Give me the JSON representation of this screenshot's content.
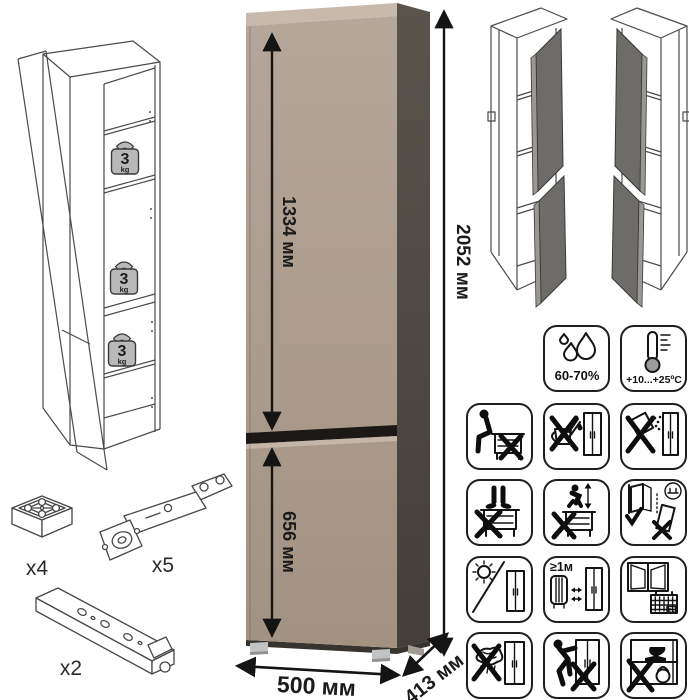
{
  "page": {
    "background": "#ffffff"
  },
  "colors": {
    "cabinet_front_top": "#b4a699",
    "cabinet_front_bottom": "#a29282",
    "cabinet_top_strip": "#c7b9ac",
    "cabinet_side": "#4d4944",
    "door_gap": "#1b1815",
    "open_door": "#6e6c69",
    "open_door_edge": "#9b9893",
    "line_art": "#4b4b4b",
    "ink": "#161616",
    "weight_badge": "#b9b9b9"
  },
  "dimensions": {
    "top_door_height": "1334 мм",
    "bottom_door_height": "656 мм",
    "total_height": "2052 мм",
    "width": "500 мм",
    "depth": "413 мм"
  },
  "shelf_load": {
    "value": "3",
    "unit": "kg",
    "badge_count": 3
  },
  "environment": {
    "humidity": "60-70%",
    "temperature": "+10...+25ºC"
  },
  "care": {
    "min_heat_distance": "≥1м",
    "calendar_day": "21"
  },
  "hardware": {
    "foot": {
      "label": "x4"
    },
    "hinge": {
      "label": "x5"
    },
    "rail": {
      "label": "x2"
    }
  },
  "warning_icons": [
    "humidity-60-70",
    "temperature-range",
    "do-not-sit-on-furniture",
    "do-not-pour-liquids",
    "do-not-spill-abrasives",
    "do-not-stand-on-furniture",
    "do-not-jump-on-furniture",
    "anchor-to-wall",
    "avoid-direct-sunlight",
    "keep-1m-from-heat-source",
    "ventilate-room",
    "do-not-clean-with-wet-cloth",
    "do-not-push-or-drag",
    "do-not-overload"
  ]
}
